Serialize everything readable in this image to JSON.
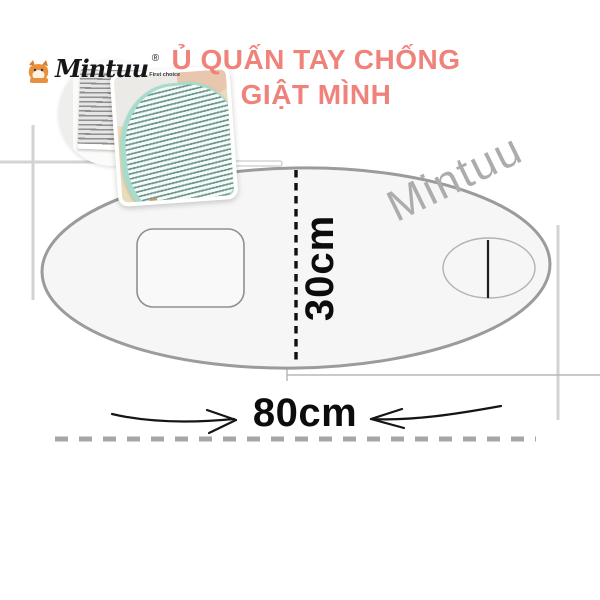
{
  "logo": {
    "brand": "Mintuu",
    "registered_mark": "®",
    "tagline": "First choice"
  },
  "header": {
    "title_line1": "Ủ QUẤN TAY CHỐNG",
    "title_line2": "GIẬT MÌNH",
    "title_color": "#ef837b"
  },
  "watermark": {
    "text": "Mintuu",
    "color": "#acacac"
  },
  "diagram": {
    "type": "dimension-diagram",
    "height_label": "30cm",
    "width_label": "80cm",
    "outline_color": "#9b9b9b",
    "fill_color": "#f6f6f6",
    "dimension_text_color": "#0c0c0c"
  },
  "photos": [
    {
      "label": "folded swaddle with gray stripes"
    },
    {
      "label": "baby wrapped in mint striped swaddle"
    }
  ]
}
